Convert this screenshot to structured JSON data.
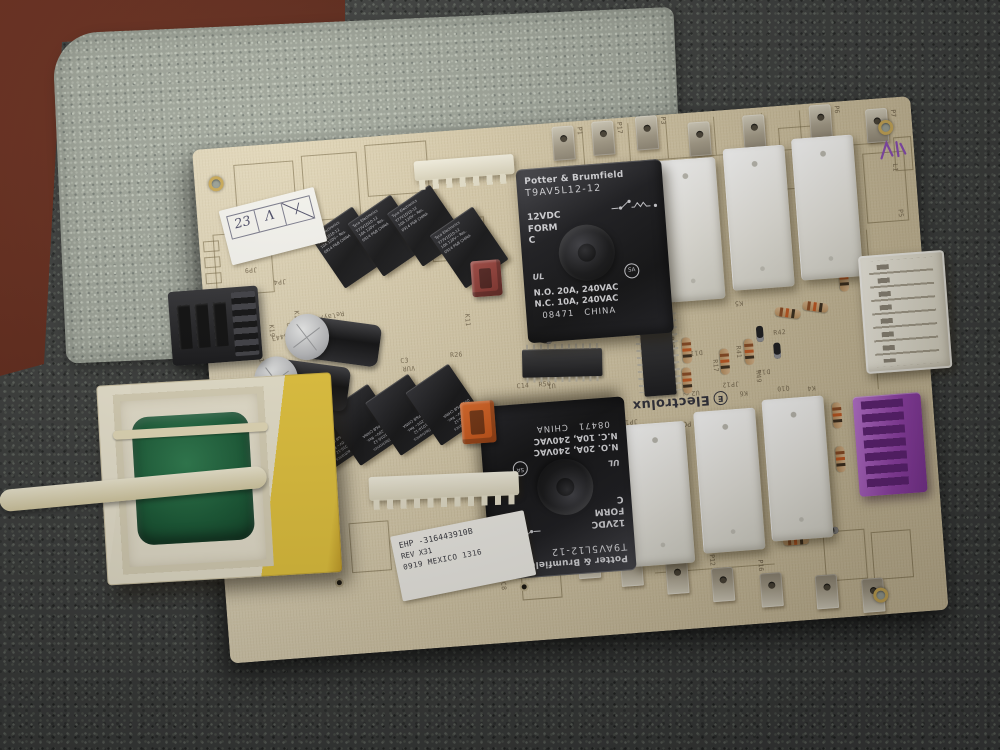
{
  "scene": {
    "description": "Electrolux oven relay/power control circuit board photographed on carpet",
    "colors": {
      "board": "#dccfae",
      "carpet": "#3b3d3c",
      "foam_mat": "#9fa59a",
      "table": "#582418",
      "purple_connector": "#9340ab",
      "orange_connector": "#d4561e",
      "red_connector": "#8a3530",
      "transformer_yellow": "#e8c73c",
      "coil_green": "#175a35"
    }
  },
  "brand": {
    "logo": "Electrolux",
    "logo_initial": "E",
    "pcb_rev": "PCB-0029, Rev. H"
  },
  "big_relay": {
    "brand": "Potter & Brumfield",
    "model": "T9AV5L12-12",
    "coil_voltage": "12VDC",
    "form_label": "FORM",
    "form_value": "C",
    "no_rating": "N.O. 20A, 240VAC",
    "nc_rating": "N.C. 10A, 240VAC",
    "date_code": "08471",
    "country": "CHINA",
    "cert_ul": "UL",
    "cert_csa": "SA"
  },
  "small_relay": {
    "brand": "Tyco Electronics",
    "model": "T77V1D10-12",
    "rating": "10A 120V~ Res.",
    "code": "0914  P&B  CHINA"
  },
  "stickers": {
    "qc_cells": [
      "23",
      "Λ",
      "∕"
    ],
    "id_line1": "EHP -316443910B",
    "id_line2": "REV X31",
    "id_line3": "0919 MEXICO 1316"
  },
  "sprites": [
    {
      "t": "term",
      "x": 360,
      "y": 4,
      "l": "P1"
    },
    {
      "t": "term",
      "x": 400,
      "y": 2,
      "l": "P17"
    },
    {
      "t": "term",
      "x": 444,
      "y": 0,
      "l": "P3"
    },
    {
      "t": "term",
      "x": 496,
      "y": 10
    },
    {
      "t": "term",
      "x": 551,
      "y": 7
    },
    {
      "t": "term",
      "x": 618,
      "y": 2,
      "l": "P6"
    },
    {
      "t": "term",
      "x": 674,
      "y": 10,
      "l": "P7"
    },
    {
      "t": "term",
      "d": 1,
      "x": 317,
      "y": 414
    },
    {
      "t": "term",
      "d": 1,
      "x": 354,
      "y": 423,
      "l": "P10"
    },
    {
      "t": "term",
      "d": 1,
      "x": 396,
      "y": 434,
      "l": "P2"
    },
    {
      "t": "term",
      "d": 1,
      "x": 441,
      "y": 445
    },
    {
      "t": "term",
      "d": 1,
      "x": 486,
      "y": 456,
      "l": "P12"
    },
    {
      "t": "term",
      "d": 1,
      "x": 534,
      "y": 465,
      "l": "P16"
    },
    {
      "t": "term",
      "d": 1,
      "x": 589,
      "y": 471
    },
    {
      "t": "term",
      "d": 1,
      "x": 635,
      "y": 478
    },
    {
      "t": "sr",
      "x": 123,
      "y": 77
    },
    {
      "t": "sr",
      "x": 162,
      "y": 68
    },
    {
      "t": "sr",
      "x": 202,
      "y": 61
    },
    {
      "t": "sr",
      "x": 243,
      "y": 86
    },
    {
      "t": "sr",
      "f": 1,
      "x": 87,
      "y": 262
    },
    {
      "t": "sr",
      "f": 1,
      "x": 125,
      "y": 255
    },
    {
      "t": "sr",
      "f": 1,
      "x": 166,
      "y": 248
    },
    {
      "t": "sr",
      "f": 1,
      "x": 207,
      "y": 241
    },
    {
      "t": "wr",
      "x": 459,
      "y": 46
    },
    {
      "t": "wr",
      "x": 529,
      "y": 39
    },
    {
      "t": "wr",
      "x": 598,
      "y": 34
    },
    {
      "t": "wr",
      "x": 409,
      "y": 307
    },
    {
      "t": "wr",
      "x": 480,
      "y": 299
    },
    {
      "t": "wr",
      "x": 549,
      "y": 292
    },
    {
      "t": "cap",
      "x": 84,
      "y": 168,
      "w": 95,
      "h": 46,
      "r": 12
    },
    {
      "t": "cap",
      "x": 50,
      "y": 208,
      "w": 95,
      "h": 48,
      "r": 12
    },
    {
      "t": "bead",
      "x": 147,
      "y": 210
    },
    {
      "t": "ic",
      "dir": "h",
      "x": 314,
      "y": 224,
      "w": 80,
      "h": 28,
      "r": 3
    },
    {
      "t": "ic",
      "dir": "v",
      "x": 433,
      "y": 194,
      "w": 32,
      "h": 86
    },
    {
      "t": "res",
      "x": 483,
      "y": 224,
      "r": 90
    },
    {
      "t": "res",
      "x": 481,
      "y": 254,
      "r": 90
    },
    {
      "t": "res",
      "x": 520,
      "y": 238,
      "r": 90
    },
    {
      "t": "res",
      "x": 545,
      "y": 230,
      "r": 90
    },
    {
      "t": "res",
      "x": 570,
      "y": 200,
      "r": 12
    },
    {
      "t": "res",
      "x": 598,
      "y": 196,
      "r": 12
    },
    {
      "t": "res",
      "x": 645,
      "y": 164,
      "r": 90
    },
    {
      "t": "res",
      "x": 628,
      "y": 300,
      "r": 90
    },
    {
      "t": "res",
      "x": 628,
      "y": 344,
      "r": 90
    },
    {
      "t": "res",
      "x": 560,
      "y": 430
    },
    {
      "t": "di",
      "x": 330,
      "y": 210,
      "r": 15
    },
    {
      "t": "di",
      "x": 556,
      "y": 218,
      "r": 90
    },
    {
      "t": "di",
      "x": 572,
      "y": 236,
      "r": 90
    },
    {
      "t": "di",
      "x": 600,
      "y": 424
    },
    {
      "t": "hole",
      "x": 14,
      "y": 28
    },
    {
      "t": "hole",
      "x": 686,
      "y": 22
    },
    {
      "t": "hole",
      "x": 646,
      "y": 488
    },
    {
      "t": "via",
      "x": 110,
      "y": 438
    },
    {
      "t": "via",
      "x": 294,
      "y": 456
    },
    {
      "t": "box",
      "x": 40,
      "y": 18,
      "w": 60,
      "h": 54
    },
    {
      "t": "box",
      "x": 108,
      "y": 14,
      "w": 56,
      "h": 66
    },
    {
      "t": "box",
      "x": 172,
      "y": 8,
      "w": 62,
      "h": 52
    },
    {
      "t": "box",
      "x": 14,
      "y": 86,
      "w": 58,
      "h": 62
    },
    {
      "t": "box",
      "x": 232,
      "y": 88,
      "w": 54,
      "h": 42
    },
    {
      "t": "box",
      "x": 4,
      "y": 92,
      "w": 16,
      "h": 11
    },
    {
      "t": "box",
      "x": 4,
      "y": 108,
      "w": 16,
      "h": 11
    },
    {
      "t": "box",
      "x": 4,
      "y": 124,
      "w": 16,
      "h": 11
    },
    {
      "t": "box",
      "x": 586,
      "y": 22,
      "w": 44,
      "h": 62
    },
    {
      "t": "box",
      "x": 668,
      "y": 54,
      "w": 42,
      "h": 70
    },
    {
      "t": "box",
      "x": 700,
      "y": 40,
      "w": 18,
      "h": 34
    },
    {
      "t": "box",
      "x": 600,
      "y": 428,
      "w": 42,
      "h": 50
    },
    {
      "t": "box",
      "x": 648,
      "y": 432,
      "w": 40,
      "h": 48
    },
    {
      "t": "box",
      "x": 128,
      "y": 384,
      "w": 40,
      "h": 50
    },
    {
      "t": "box",
      "x": 296,
      "y": 430,
      "w": 40,
      "h": 44
    },
    {
      "t": "line",
      "x": 356,
      "y": 44,
      "w": 334,
      "h": 1
    },
    {
      "t": "line",
      "x": 390,
      "y": 6,
      "w": 1,
      "h": 38
    },
    {
      "t": "line",
      "x": 436,
      "y": 6,
      "w": 1,
      "h": 38
    },
    {
      "t": "line",
      "x": 474,
      "y": 6,
      "w": 1,
      "h": 38
    },
    {
      "t": "line",
      "x": 522,
      "y": 6,
      "w": 1,
      "h": 38
    },
    {
      "t": "line",
      "x": 570,
      "y": 6,
      "w": 1,
      "h": 38
    },
    {
      "t": "line",
      "x": 608,
      "y": 6,
      "w": 1,
      "h": 38
    },
    {
      "t": "line",
      "x": 666,
      "y": 130,
      "w": 1,
      "h": 160
    },
    {
      "t": "line",
      "x": 300,
      "y": 440,
      "w": 90,
      "h": 1
    },
    {
      "t": "line",
      "x": 430,
      "y": 456,
      "w": 120,
      "h": 1
    },
    {
      "t": "lb",
      "x": 266,
      "y": 184,
      "r": 90,
      "s": "K11"
    },
    {
      "t": "lb",
      "x": 96,
      "y": 168,
      "r": 90,
      "s": "K18"
    },
    {
      "t": "lb",
      "x": 70,
      "y": 180,
      "r": 90,
      "s": "K19"
    },
    {
      "t": "lb",
      "x": 230,
      "y": 266,
      "r": 90,
      "s": "K12"
    },
    {
      "t": "lb",
      "x": 152,
      "y": 270,
      "r": 90,
      "s": "K15"
    },
    {
      "t": "lb",
      "x": 118,
      "y": 275,
      "r": 90,
      "s": "K17"
    },
    {
      "t": "lb",
      "x": 242,
      "y": 220,
      "s": "R26"
    },
    {
      "t": "lb",
      "x": 192,
      "y": 222,
      "s": "C3"
    },
    {
      "t": "lb",
      "x": 206,
      "y": 238,
      "r": 180,
      "s": "VUR"
    },
    {
      "t": "lb",
      "x": 306,
      "y": 256,
      "s": "C14"
    },
    {
      "t": "lb",
      "x": 328,
      "y": 256,
      "s": "R50"
    },
    {
      "t": "lb",
      "x": 348,
      "y": 206,
      "r": 20,
      "s": "D7"
    },
    {
      "t": "lb",
      "x": 396,
      "y": 202,
      "r": 90,
      "s": "R31"
    },
    {
      "t": "lb",
      "x": 356,
      "y": 242,
      "r": 90,
      "s": "R9"
    },
    {
      "t": "lb",
      "x": 345,
      "y": 266,
      "r": 180,
      "s": "U1"
    },
    {
      "t": "lb",
      "x": 478,
      "y": 270,
      "r": 90,
      "s": "R12"
    },
    {
      "t": "lb",
      "x": 468,
      "y": 222,
      "r": 90,
      "s": "R13"
    },
    {
      "t": "lb",
      "x": 510,
      "y": 248,
      "r": 90,
      "s": "R17"
    },
    {
      "t": "lb",
      "x": 534,
      "y": 236,
      "r": 90,
      "s": "R41"
    },
    {
      "t": "lb",
      "x": 566,
      "y": 222,
      "s": "R42"
    },
    {
      "t": "lb",
      "x": 552,
      "y": 262,
      "r": 90,
      "s": "R49"
    },
    {
      "t": "lb",
      "x": 538,
      "y": 198,
      "r": 180,
      "s": "K5"
    },
    {
      "t": "lb",
      "x": 470,
      "y": 190,
      "r": 180,
      "s": "K7"
    },
    {
      "t": "lb",
      "x": 488,
      "y": 284,
      "r": 180,
      "s": "U2"
    },
    {
      "t": "lb",
      "x": 452,
      "y": 230,
      "r": 180,
      "s": "JP11"
    },
    {
      "t": "lb",
      "x": 528,
      "y": 278,
      "r": 180,
      "s": "JP12"
    },
    {
      "t": "lb",
      "x": 424,
      "y": 308,
      "r": 180,
      "s": "JP13"
    },
    {
      "t": "lb",
      "x": 494,
      "y": 244,
      "r": 180,
      "s": "D11"
    },
    {
      "t": "lb",
      "x": 560,
      "y": 268,
      "r": 180,
      "s": "D12"
    },
    {
      "t": "lb",
      "x": 644,
      "y": 176,
      "r": 90,
      "s": "R40"
    },
    {
      "t": "lb",
      "x": 706,
      "y": 112,
      "r": 90,
      "s": "P5"
    },
    {
      "t": "lb",
      "x": 704,
      "y": 66,
      "r": 90,
      "s": "L1"
    },
    {
      "t": "lb",
      "x": 690,
      "y": 352,
      "r": 90,
      "s": "R11"
    },
    {
      "t": "lb",
      "x": 578,
      "y": 286,
      "r": 180,
      "s": "Q10"
    },
    {
      "t": "lb",
      "x": 604,
      "y": 288,
      "r": 180,
      "s": "K4"
    },
    {
      "t": "lb",
      "x": 536,
      "y": 288,
      "r": 180,
      "s": "K6"
    },
    {
      "t": "lb",
      "x": 124,
      "y": 190,
      "r": 172,
      "s": "EHA P/N 316443"
    },
    {
      "t": "lb",
      "x": 140,
      "y": 178,
      "r": 172,
      "s": "Relay/PWR, PCB"
    },
    {
      "t": "lb",
      "x": 55,
      "y": 200,
      "r": 80,
      "s": "09 10"
    },
    {
      "t": "lb",
      "x": 56,
      "y": 128,
      "r": 180,
      "s": "JP9"
    },
    {
      "t": "lb",
      "x": 84,
      "y": 142,
      "r": 180,
      "s": "JP4"
    },
    {
      "t": "lb",
      "x": 276,
      "y": 420,
      "r": 90,
      "s": "C9"
    },
    {
      "t": "lb",
      "x": 282,
      "y": 454,
      "r": 90,
      "s": "C8"
    }
  ]
}
